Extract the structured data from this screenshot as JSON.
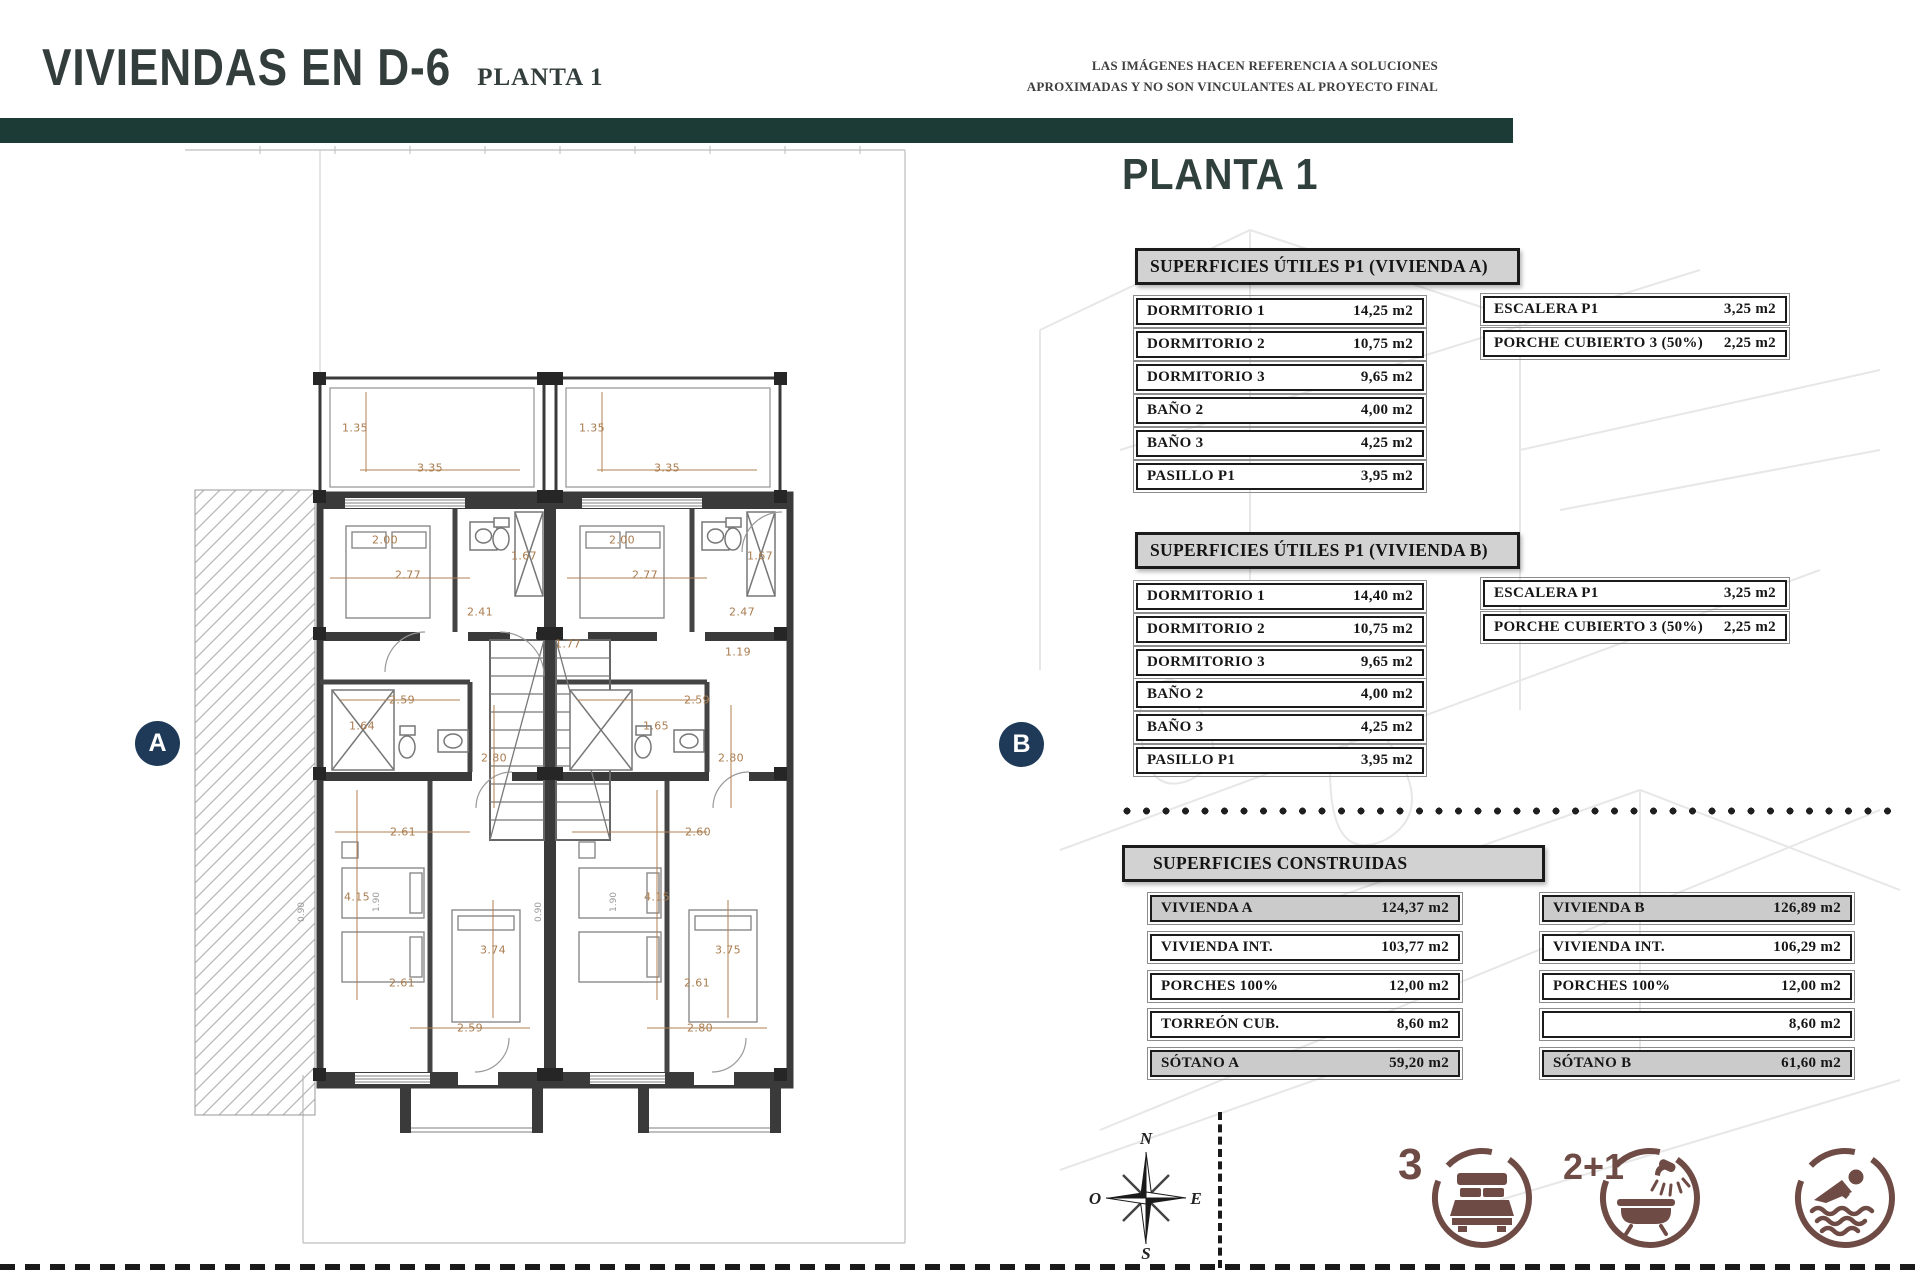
{
  "header": {
    "title": "VIVIENDAS EN D-6",
    "subtitle": "PLANTA 1",
    "disclaimer_line1": "LAS IMÁGENES HACEN REFERENCIA A SOLUCIONES",
    "disclaimer_line2": "APROXIMADAS Y NO SON VINCULANTES AL PROYECTO FINAL"
  },
  "panel": {
    "heading": "PLANTA 1",
    "utiles_a": {
      "title": "SUPERFICIES ÚTILES P1 (VIVIENDA A)",
      "rows": [
        {
          "label": "DORMITORIO 1",
          "value": "14,25 m2"
        },
        {
          "label": "DORMITORIO 2",
          "value": "10,75 m2"
        },
        {
          "label": "DORMITORIO 3",
          "value": "9,65 m2"
        },
        {
          "label": "BAÑO 2",
          "value": "4,00 m2"
        },
        {
          "label": "BAÑO 3",
          "value": "4,25 m2"
        },
        {
          "label": "PASILLO P1",
          "value": "3,95 m2"
        }
      ],
      "side_rows": [
        {
          "label": "ESCALERA P1",
          "value": "3,25 m2"
        },
        {
          "label": "PORCHE CUBIERTO 3 (50%)",
          "value": "2,25 m2"
        }
      ]
    },
    "utiles_b": {
      "title": "SUPERFICIES ÚTILES P1 (VIVIENDA B)",
      "rows": [
        {
          "label": "DORMITORIO 1",
          "value": "14,40 m2"
        },
        {
          "label": "DORMITORIO 2",
          "value": "10,75 m2"
        },
        {
          "label": "DORMITORIO 3",
          "value": "9,65 m2"
        },
        {
          "label": "BAÑO 2",
          "value": "4,00 m2"
        },
        {
          "label": "BAÑO 3",
          "value": "4,25 m2"
        },
        {
          "label": "PASILLO P1",
          "value": "3,95 m2"
        }
      ],
      "side_rows": [
        {
          "label": "ESCALERA P1",
          "value": "3,25 m2"
        },
        {
          "label": "PORCHE CUBIERTO 3 (50%)",
          "value": "2,25 m2"
        }
      ]
    },
    "construidas": {
      "title": "SUPERFICIES CONSTRUIDAS",
      "col_a": [
        {
          "label": "VIVIENDA A",
          "value": "124,37 m2"
        },
        {
          "label": "VIVIENDA INT.",
          "value": "103,77 m2"
        },
        {
          "label": "PORCHES 100%",
          "value": "12,00 m2"
        },
        {
          "label": "TORREÓN CUB.",
          "value": "8,60 m2"
        },
        {
          "label": "SÓTANO A",
          "value": "59,20 m2"
        }
      ],
      "col_b": [
        {
          "label": "VIVIENDA B",
          "value": "126,89 m2"
        },
        {
          "label": "VIVIENDA INT.",
          "value": "106,29 m2"
        },
        {
          "label": "PORCHES 100%",
          "value": "12,00 m2"
        },
        {
          "label": "TORREÓN CUB.",
          "value": "8,60 m2"
        },
        {
          "label": "SÓTANO B",
          "value": "61,60 m2"
        }
      ]
    }
  },
  "plan": {
    "marker_a": "A",
    "marker_b": "B",
    "dims": [
      "1.35",
      "3.35",
      "2.00",
      "1.67",
      "2.77",
      "2.41",
      "1.77",
      "2.59",
      "1.64",
      "2.80",
      "2.61",
      "4.15",
      "3.74",
      "2.61",
      "2.59",
      "1.35",
      "3.35",
      "2.00",
      "1.67",
      "2.77",
      "2.47",
      "1.19",
      "2.59",
      "1.65",
      "2.80",
      "2.60",
      "4.15",
      "3.75",
      "2.61",
      "2.80"
    ],
    "small_dims": [
      "1.90",
      "1.90",
      "0.90",
      "0.90"
    ]
  },
  "compass": {
    "n": "N",
    "e": "E",
    "s": "S",
    "o": "O"
  },
  "features": {
    "bedrooms": "3",
    "bathrooms": "2+1"
  },
  "colors": {
    "teal": "#1c3b36",
    "navy": "#1e3a58",
    "icon_brown": "#6f4b45",
    "dim_text": "#a97c4f",
    "header_gray": "#d2d2d2"
  }
}
